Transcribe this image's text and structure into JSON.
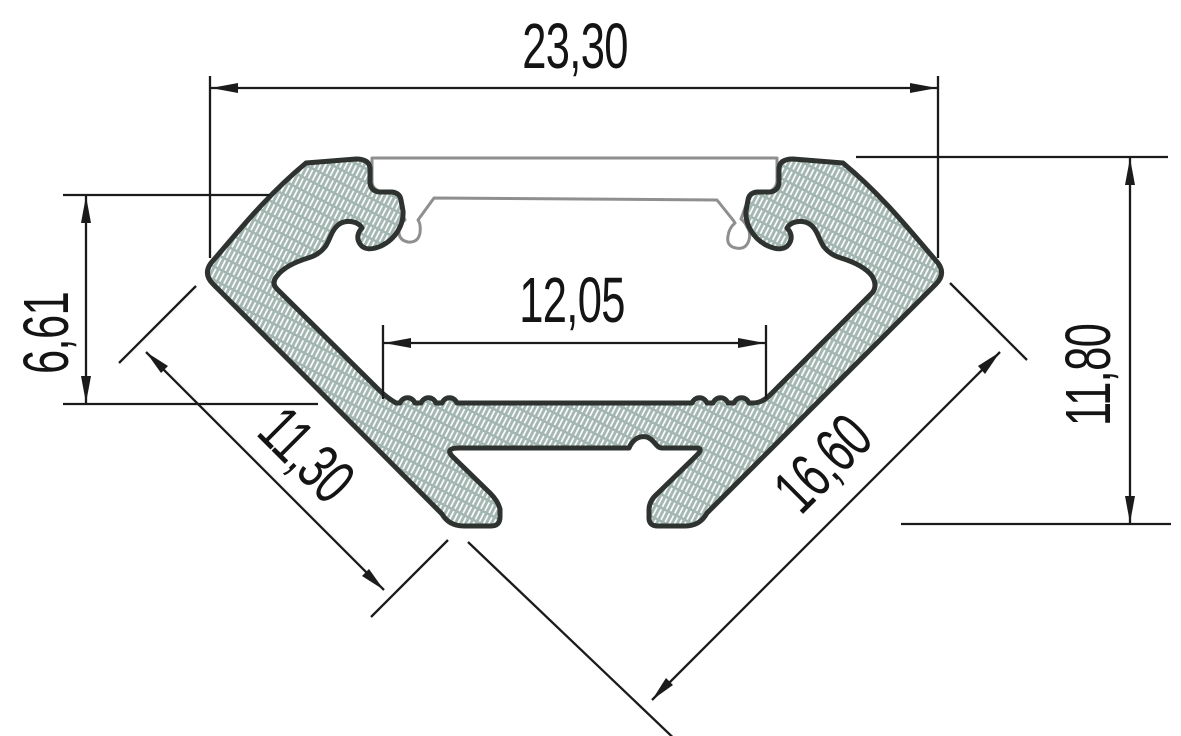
{
  "drawing": {
    "title": "LED corner aluminium profile cross-section dimension drawing",
    "dimensions": {
      "overall_width": "23,30",
      "wing_height": "6,61",
      "inner_width": "12,05",
      "right_height": "11,80",
      "left_flange": "11,30",
      "right_flange": "16,60"
    },
    "colors": {
      "background": "#ffffff",
      "aluminium_fill": "#a3b6b1",
      "hatch_line": "#ffffff",
      "profile_outline": "#2e3330",
      "cover_outline": "#8f8f8f",
      "dimension_line": "#1b1b1b",
      "text": "#141414"
    }
  }
}
